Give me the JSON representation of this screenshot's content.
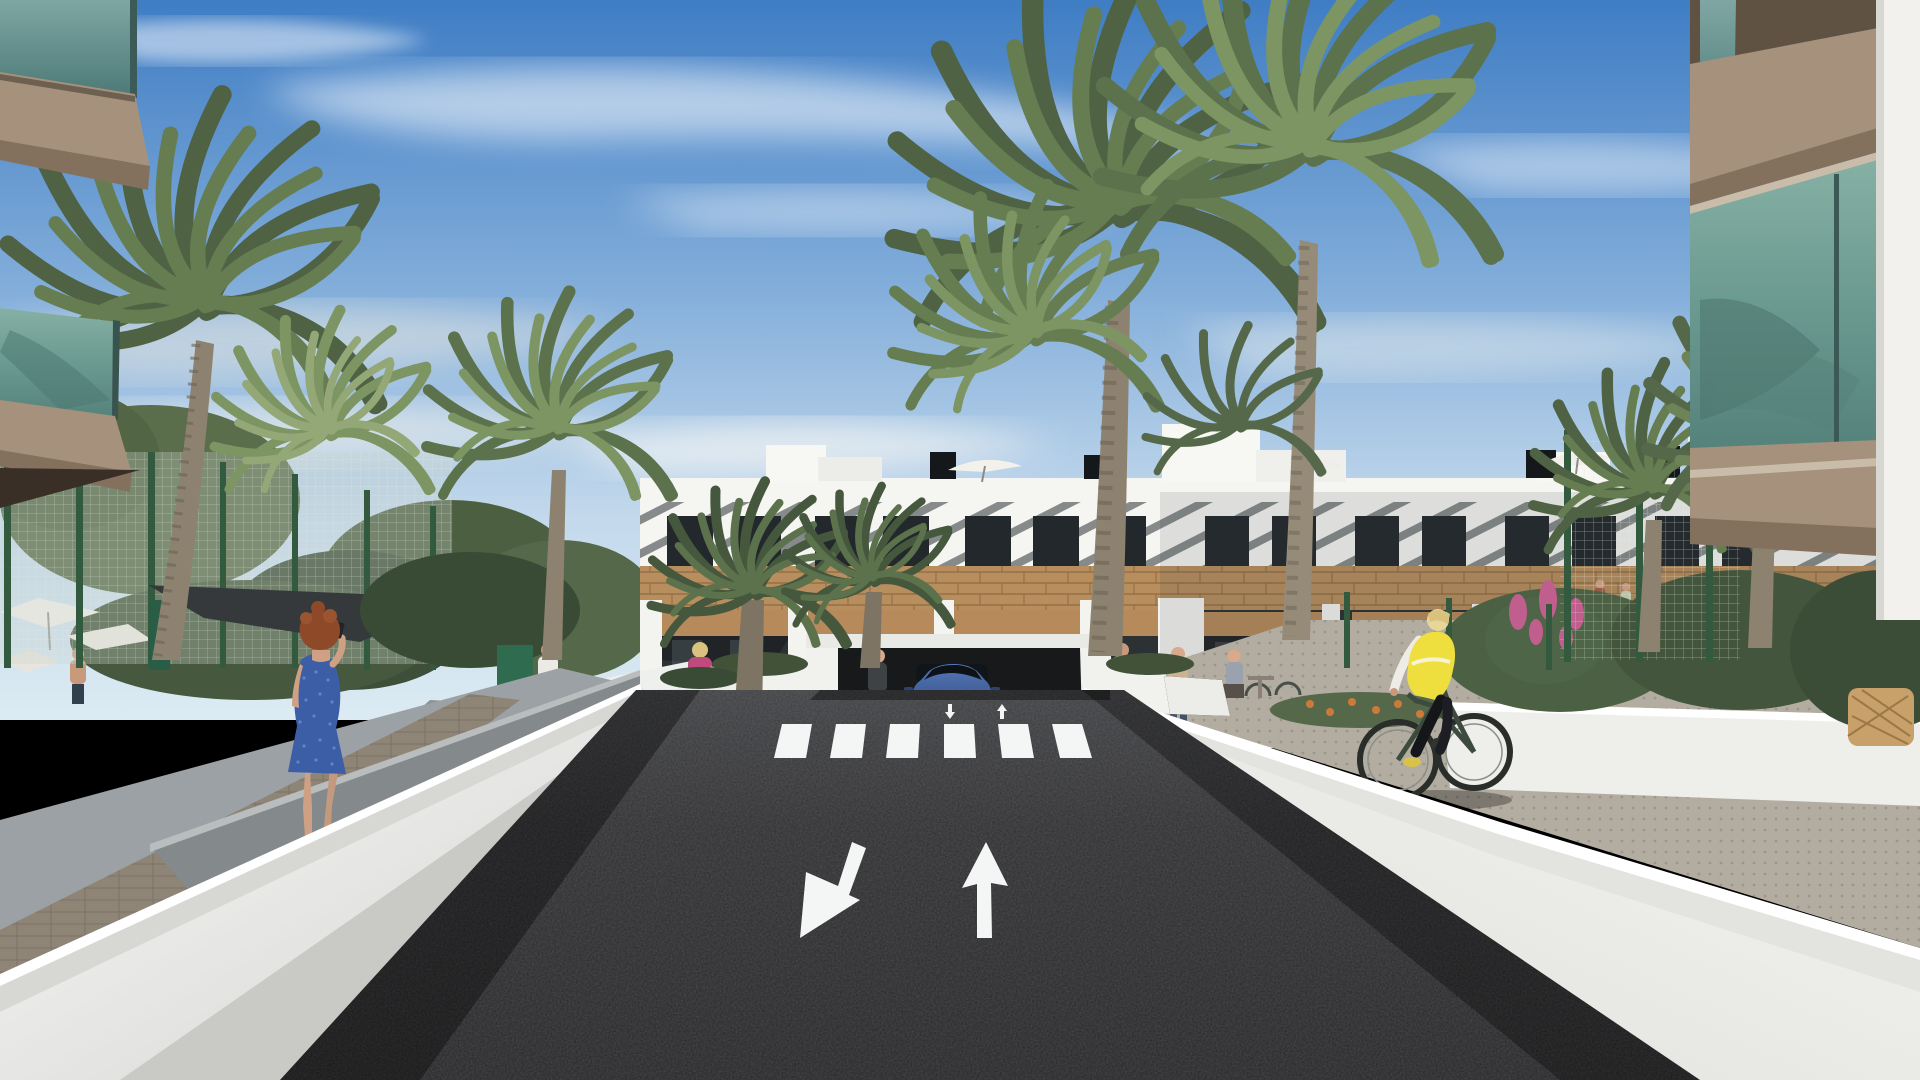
{
  "scene": {
    "type": "architectural-3d-render",
    "setting": "Modern white Mediterranean apartment complex with palm trees, seen from the entrance ramp of an underground parking garage on a sunny day",
    "road_markings": {
      "large_lane_arrows": [
        "down-left (exit lane)",
        "straight-up (entry lane)"
      ],
      "small_ramp_arrows": [
        "down",
        "up"
      ],
      "crosswalk_stripes": 6
    },
    "vehicles": [
      {
        "type": "suv",
        "color_name": "blue",
        "location": "emerging from parking garage entrance"
      }
    ],
    "people": [
      {
        "id": "woman-blue-dress",
        "desc": "red-haired woman in blue patterned dress talking on phone, left sidewalk"
      },
      {
        "id": "cyclist",
        "desc": "blonde cyclist in yellow vest and black leggings riding on right path"
      },
      {
        "id": "man-white-shirt",
        "desc": "man in white shirt walking on left garden path"
      },
      {
        "id": "woman-pink-jacket",
        "desc": "blonde woman in pink jacket carrying a handbag"
      },
      {
        "id": "woman-by-garage",
        "desc": "woman standing beside garage planter wall"
      },
      {
        "id": "woman-with-bicycle",
        "desc": "woman pushing a bicycle near right sidewalk"
      },
      {
        "id": "mother-and-child",
        "desc": "woman with small child right of the garage"
      },
      {
        "id": "seated-person",
        "desc": "person seated at a table on the right terrace"
      },
      {
        "id": "pool-bather",
        "desc": "shirtless man near pool area far left"
      },
      {
        "id": "balcony-residents",
        "desc": "two tiny figures on a right-wing balcony"
      }
    ],
    "vegetation": {
      "tall_palms": 9,
      "small_palms": 4,
      "shade_sail": 1,
      "white_parasols": 4,
      "pink_flower_bush": 1,
      "orange_flower_bed": 1
    }
  },
  "colors": {
    "sky_top": "#3f7dc4",
    "sky_mid": "#7fabd9",
    "sky_low": "#c3d9ec",
    "sky_horizon": "#dcebf3",
    "cloud": "#ffffff",
    "facade_white": "#f5f5f2",
    "stripe_dark": "#63686b",
    "window_dark": "#23282c",
    "wood": "#bd9263",
    "wood_dark": "#8f6a42",
    "interior_dark": "#2c3134",
    "glass_teal": "#5f8e8a",
    "glass_green": "#74a097",
    "slab_tan": "#a5917c",
    "slab_front": "#83715d",
    "asphalt": "#2b2b2e",
    "asphalt_far": "#3e3f42",
    "marking_white": "#f4f6f5",
    "wall_sunlit": "#f1f1ee",
    "wall_top": "#d7d8d4",
    "wall_shadow": "#a9adae",
    "sidewalk": "#9ba1a4",
    "paver_brown": "#8e8577",
    "path_right": "#b3aca0",
    "garden_wall": "#eeeeea",
    "palm_dark": "#4f6244",
    "palm_mid": "#667d52",
    "palm_light": "#7d9562",
    "trunk": "#8d8270",
    "foliage_dark": "#3d4f38",
    "foliage_mid": "#55694a",
    "fence_post": "#33593f",
    "fence_mesh": "#c9d4c9",
    "shade_sail": "#35393b",
    "lawn": "#7c995e",
    "flower_pink": "#c05f8e",
    "flower_orange": "#cc7a3a",
    "car_blue": "#45649f",
    "car_blue_dark": "#2b4372",
    "vest_yellow": "#efdf3e",
    "dress_blue": "#3c5ea7",
    "skin": "#d9a98c",
    "hair_auburn": "#8e4a28",
    "jacket_pink": "#c04a7d"
  }
}
